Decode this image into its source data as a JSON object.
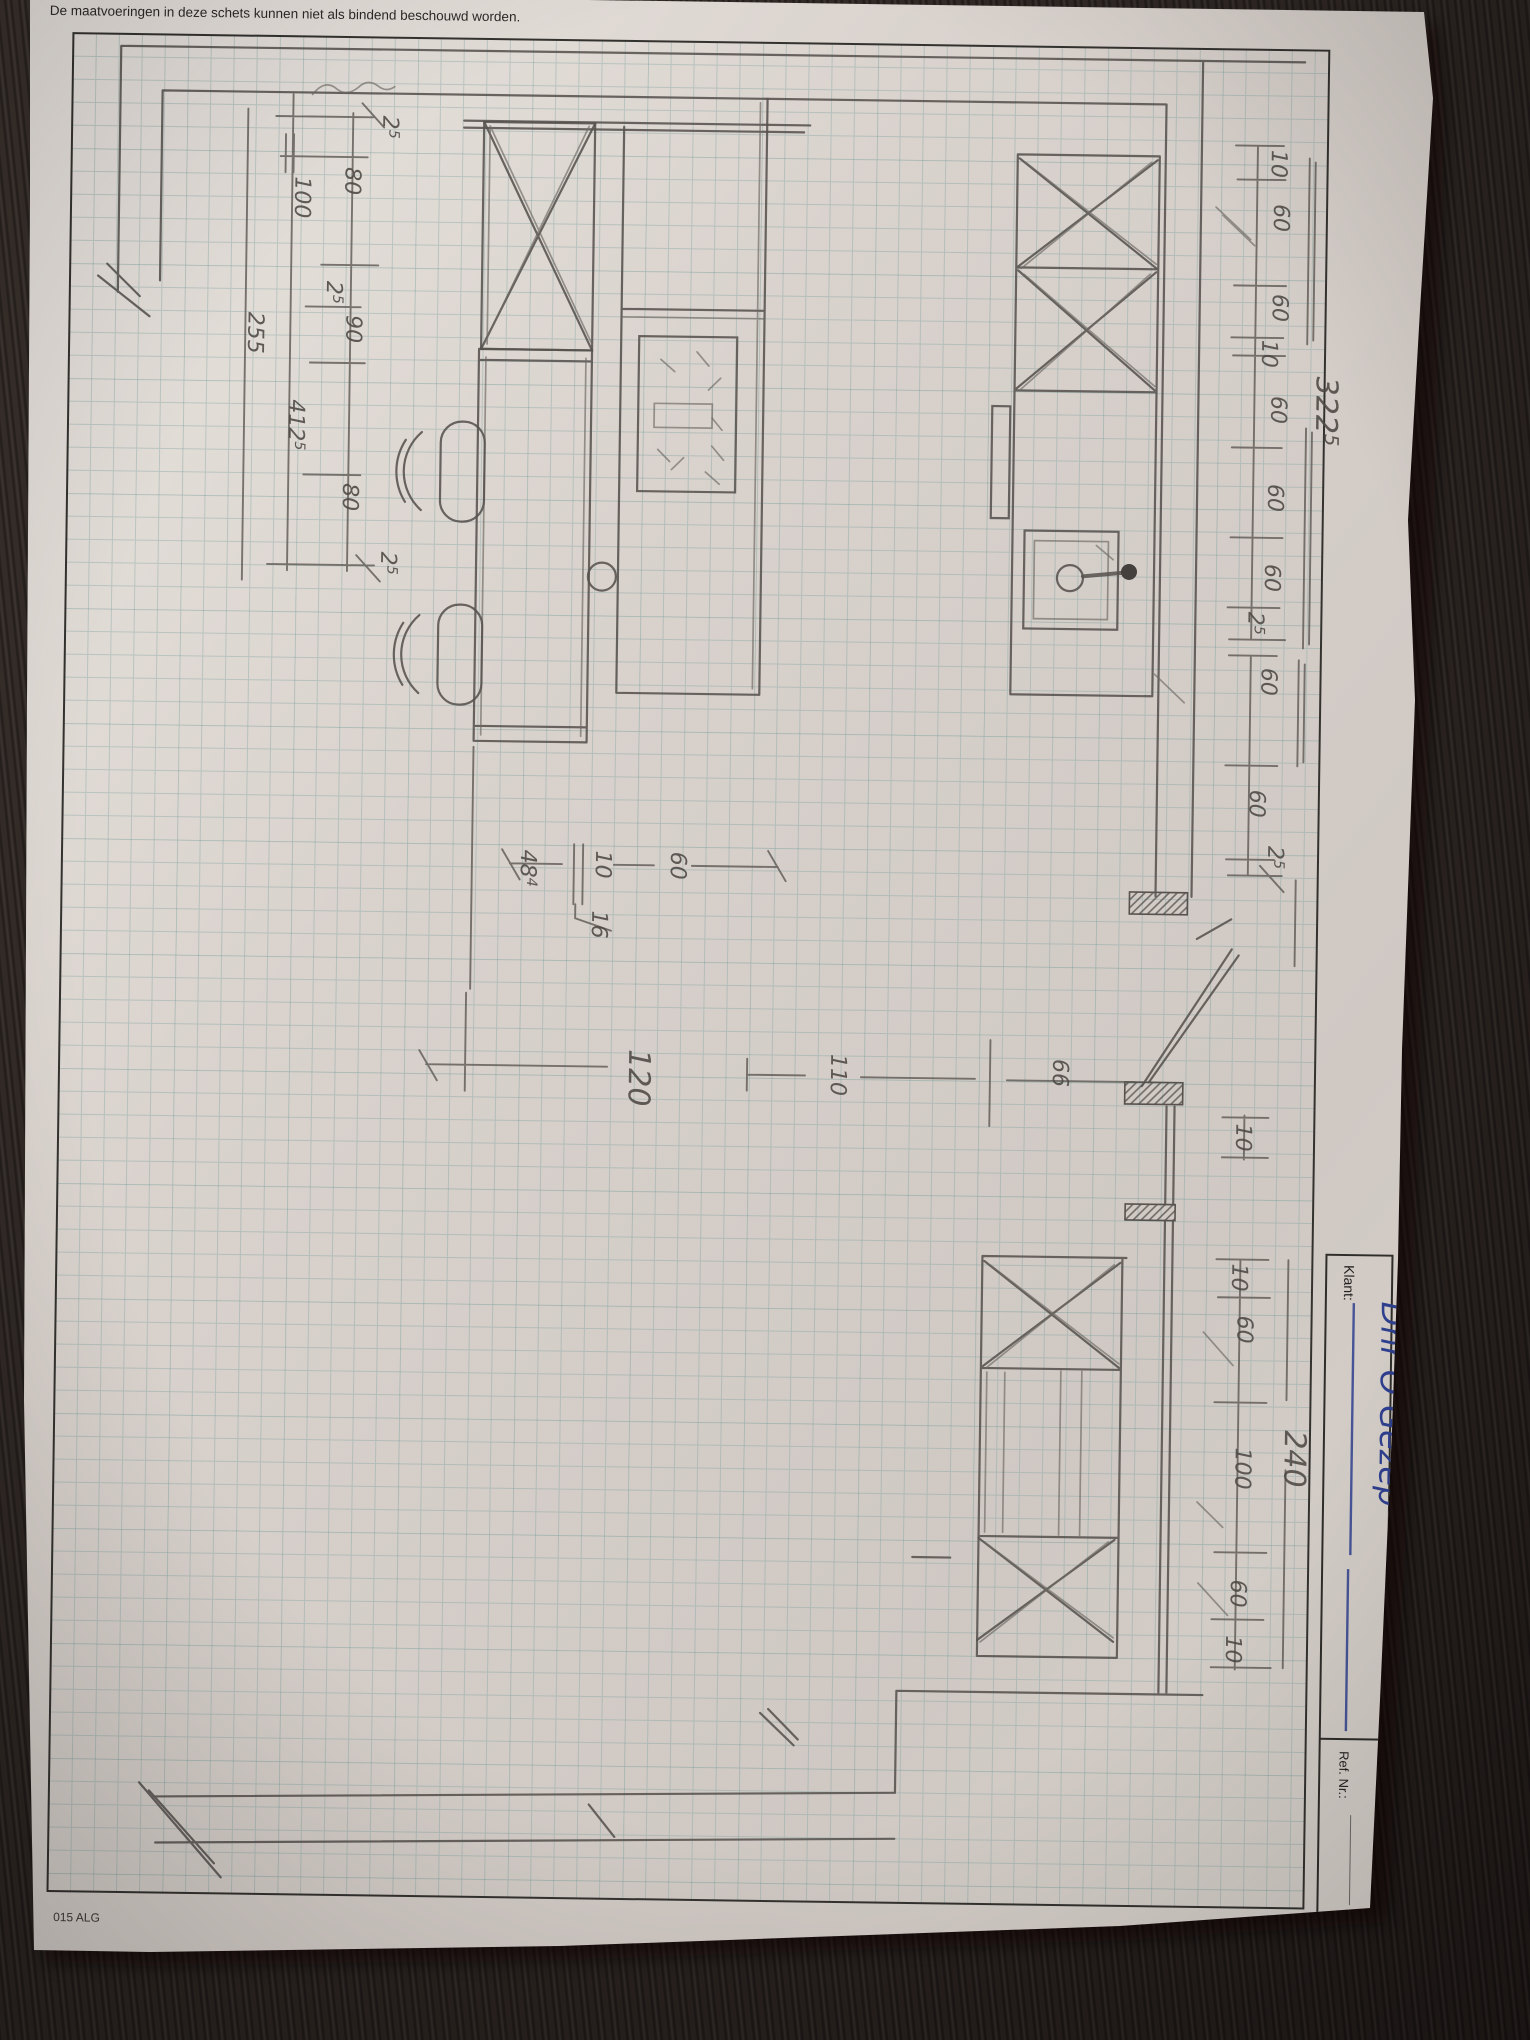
{
  "document": {
    "disclaimer": "De maatvoeringen in deze schets kunnen niet als bindend beschouwd worden.",
    "form_code": "015 ALG",
    "klant_label": "Klant:",
    "klant_value": "Dhr Ö Gezep",
    "ref_label": "Ref. Nr.:"
  },
  "sketch": {
    "type": "hand-drawn kitchen floor plan",
    "units": "cm",
    "colors": {
      "pencil": "#57524e",
      "ink": "#2e3f8e",
      "grid": "#7fa3a0",
      "paper": "#d9d3ce",
      "wood": "#2f2826"
    },
    "dimension_chains": [
      {
        "name": "top-wall-run",
        "segments": [
          "10",
          "60",
          "60",
          "10",
          "60",
          "60",
          "60",
          "2.5"
        ],
        "total": "322.5"
      },
      {
        "name": "right-wall-lower",
        "segments": [
          "60",
          "60",
          "2.5"
        ],
        "total": null
      },
      {
        "name": "bottom-wall-run",
        "segments": [
          "10",
          "60",
          "100",
          "60",
          "10"
        ],
        "total": "240"
      },
      {
        "name": "left-wall",
        "segments": [
          "2.5",
          "80",
          "100",
          "2.5",
          "90",
          "80",
          "2.5"
        ],
        "total": "412.5",
        "subtotal": "255"
      },
      {
        "name": "island",
        "segments": [
          "48.4",
          "10",
          "16",
          "60"
        ],
        "width": "120",
        "clearances": [
          "110",
          "66"
        ]
      }
    ],
    "dimension_labels": [
      {
        "text": "2",
        "sup": "5",
        "x": 371,
        "y": 120
      },
      {
        "text": "80",
        "x": 334,
        "y": 172
      },
      {
        "text": "100",
        "x": 284,
        "y": 182
      },
      {
        "text": "2",
        "sup": "5",
        "x": 317,
        "y": 286
      },
      {
        "text": "90",
        "x": 337,
        "y": 320
      },
      {
        "text": "255",
        "x": 239,
        "y": 318
      },
      {
        "text": "412",
        "sup": "5",
        "x": 281,
        "y": 405
      },
      {
        "text": "80",
        "x": 336,
        "y": 488
      },
      {
        "text": "2",
        "sup": "5",
        "x": 375,
        "y": 556
      },
      {
        "text": "10",
        "x": 1260,
        "y": 142
      },
      {
        "text": "60",
        "x": 1263,
        "y": 196
      },
      {
        "text": "60",
        "x": 1263,
        "y": 286
      },
      {
        "text": "10",
        "x": 1253,
        "y": 332
      },
      {
        "text": "60",
        "x": 1263,
        "y": 388
      },
      {
        "text": "60",
        "x": 1261,
        "y": 476
      },
      {
        "text": "60",
        "x": 1259,
        "y": 556
      },
      {
        "text": "2",
        "sup": "5",
        "x": 1243,
        "y": 604
      },
      {
        "text": "322",
        "sup": "5",
        "x": 1308,
        "y": 368,
        "size": 30
      },
      {
        "text": "60",
        "x": 1257,
        "y": 660
      },
      {
        "text": "60",
        "x": 1247,
        "y": 782
      },
      {
        "text": "2",
        "sup": "5",
        "x": 1266,
        "y": 838
      },
      {
        "text": "10",
        "x": 1238,
        "y": 1116
      },
      {
        "text": "10",
        "x": 1236,
        "y": 1256
      },
      {
        "text": "60",
        "x": 1242,
        "y": 1308
      },
      {
        "text": "100",
        "x": 1242,
        "y": 1440
      },
      {
        "text": "60",
        "x": 1239,
        "y": 1572
      },
      {
        "text": "10",
        "x": 1235,
        "y": 1628
      },
      {
        "text": "240",
        "x": 1291,
        "y": 1422,
        "size": 30
      },
      {
        "text": "48",
        "sup": "4",
        "x": 519,
        "y": 852
      },
      {
        "text": "10",
        "x": 594,
        "y": 852
      },
      {
        "text": "16",
        "x": 591,
        "y": 912
      },
      {
        "text": "60",
        "x": 669,
        "y": 852
      },
      {
        "text": "120",
        "x": 630,
        "y": 1050,
        "size": 30
      },
      {
        "text": "110",
        "x": 832,
        "y": 1052
      },
      {
        "text": "66",
        "x": 1054,
        "y": 1054
      }
    ]
  }
}
